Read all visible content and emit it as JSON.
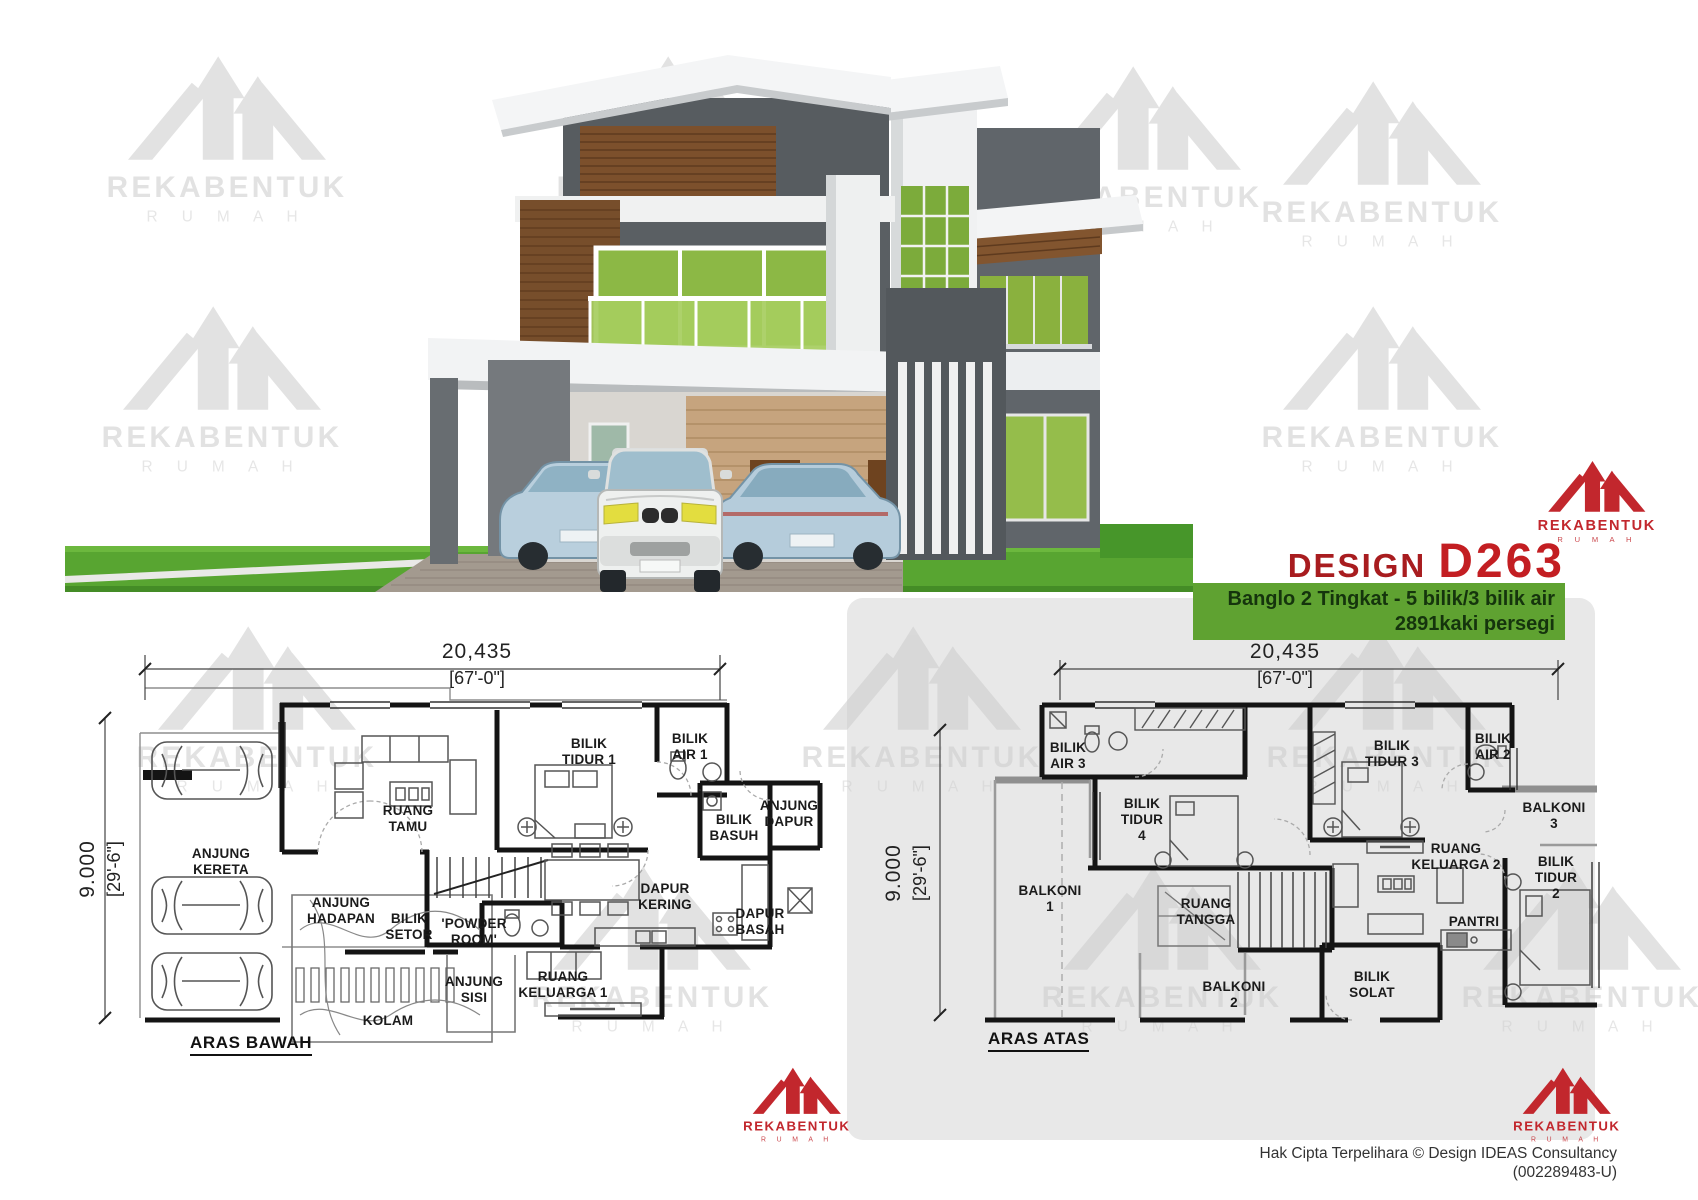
{
  "header": {
    "design_label": "DESIGN",
    "design_code": "D263",
    "subtitle_line1": "Banglo 2 Tingkat - 5 bilik/3 bilik air",
    "subtitle_line2": "2891kaki persegi"
  },
  "brand": {
    "name": "REKABENTUK",
    "word": "R U M A H"
  },
  "colors": {
    "accent_red": "#c2272d",
    "banner_green": "#5fa231",
    "banner_text": "#15340d",
    "grass_green": "#58a531",
    "panel_gray": "#e8e8e8",
    "wall_black": "#141414",
    "window_green": "#8cb845",
    "wood_brown": "#7c502c"
  },
  "plans": {
    "ground": {
      "title": "ARAS BAWAH",
      "dim_top_mm": "20,435",
      "dim_top_ft": "[67'-0\"]",
      "dim_side_mm": "9.000",
      "dim_side_ft": "[29'-6\"]",
      "rooms": [
        {
          "label": "ANJUNG\nKERETA",
          "x": 221,
          "y": 862
        },
        {
          "label": "RUANG\nTAMU",
          "x": 408,
          "y": 819
        },
        {
          "label": "BILIK\nTIDUR 1",
          "x": 589,
          "y": 752
        },
        {
          "label": "BILIK\nAIR 1",
          "x": 690,
          "y": 747
        },
        {
          "label": "BILIK\nBASUH",
          "x": 734,
          "y": 828
        },
        {
          "label": "ANJUNG\nDAPUR",
          "x": 789,
          "y": 814
        },
        {
          "label": "DAPUR\nKERING",
          "x": 665,
          "y": 897
        },
        {
          "label": "DAPUR\nBASAH",
          "x": 760,
          "y": 922
        },
        {
          "label": "ANJUNG\nHADAPAN",
          "x": 341,
          "y": 911
        },
        {
          "label": "BILIK\nSETOR",
          "x": 409,
          "y": 927
        },
        {
          "label": "'POWDER\nROOM'",
          "x": 474,
          "y": 932
        },
        {
          "label": "ANJUNG\nSISI",
          "x": 474,
          "y": 990
        },
        {
          "label": "KOLAM",
          "x": 388,
          "y": 1021
        },
        {
          "label": "RUANG\nKELUARGA 1",
          "x": 563,
          "y": 985
        }
      ]
    },
    "upper": {
      "title": "ARAS ATAS",
      "dim_top_mm": "20,435",
      "dim_top_ft": "[67'-0\"]",
      "dim_side_mm": "9.000",
      "dim_side_ft": "[29'-6\"]",
      "rooms": [
        {
          "label": "BILIK\nAIR 3",
          "x": 1068,
          "y": 756
        },
        {
          "label": "BILIK\nTIDUR\n4",
          "x": 1142,
          "y": 820
        },
        {
          "label": "BALKONI\n1",
          "x": 1050,
          "y": 899
        },
        {
          "label": "RUANG\nTANGGA",
          "x": 1206,
          "y": 912
        },
        {
          "label": "BALKONI\n2",
          "x": 1234,
          "y": 995
        },
        {
          "label": "BILIK\nSOLAT",
          "x": 1372,
          "y": 985
        },
        {
          "label": "RUANG\nKELUARGA 2",
          "x": 1456,
          "y": 857
        },
        {
          "label": "BILIK\nTIDUR 3",
          "x": 1392,
          "y": 754
        },
        {
          "label": "BILIK\nAIR 2",
          "x": 1493,
          "y": 747
        },
        {
          "label": "BALKONI\n3",
          "x": 1554,
          "y": 816
        },
        {
          "label": "BILIK\nTIDUR\n2",
          "x": 1556,
          "y": 878
        },
        {
          "label": "PANTRI",
          "x": 1474,
          "y": 922
        }
      ]
    }
  },
  "footer": {
    "line1": "Hak Cipta Terpelihara  © Design IDEAS Consultancy",
    "line2": "(002289483-U)"
  }
}
